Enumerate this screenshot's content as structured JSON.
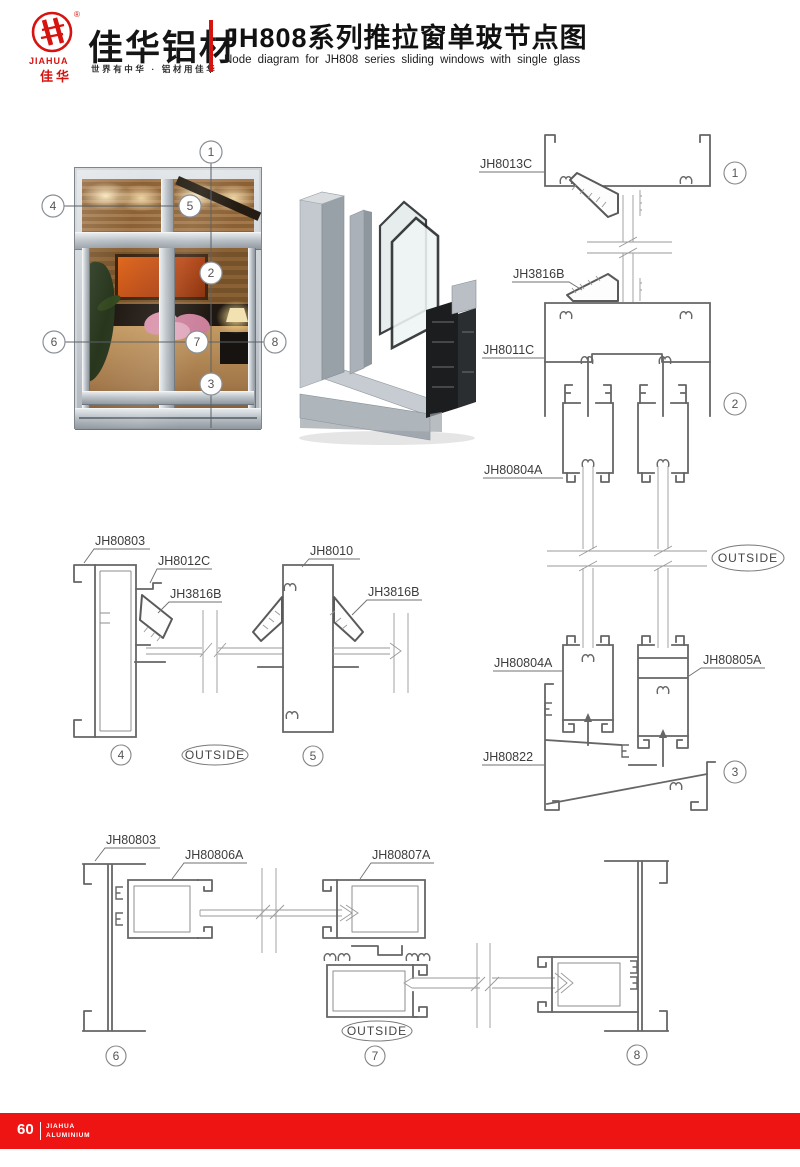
{
  "header": {
    "logo_reg": "®",
    "logo_en": "JIAHUA",
    "logo_cn": "佳华",
    "brand": "佳华铝材",
    "tagline": "世界有中华 · 铝材用佳华",
    "title_cn": "JH808系列推拉窗单玻节点图",
    "title_en": "Node diagram for JH808 series sliding windows with single glass"
  },
  "photo": {
    "callouts": [
      "1",
      "2",
      "3",
      "4",
      "5",
      "6",
      "7",
      "8"
    ]
  },
  "right_section": {
    "label_head": "JH8013C",
    "label_wedge": "JH3816B",
    "label_transom": "JH8011C",
    "label_sash_upper": "JH80804A",
    "label_sash_lower_left": "JH80804A",
    "label_sash_lower_right": "JH80805A",
    "label_sill": "JH80822",
    "outside": "OUTSIDE",
    "callout_1": "1",
    "callout_2": "2",
    "callout_3": "3"
  },
  "mid_section": {
    "label_frame": "JH80803",
    "label_sash": "JH8012C",
    "label_wedge_left": "JH3816B",
    "label_mullion": "JH8010",
    "label_wedge_right": "JH3816B",
    "outside": "OUTSIDE",
    "callout_4": "4",
    "callout_5": "5"
  },
  "bottom_section": {
    "label_frame": "JH80803",
    "label_sash_left": "JH80806A",
    "label_sash_right": "JH80807A",
    "outside": "OUTSIDE",
    "callout_6": "6",
    "callout_7": "7",
    "callout_8": "8"
  },
  "footer": {
    "page_number": "60",
    "brand_line1": "JIAHUA",
    "brand_line2": "ALUMINIUM"
  },
  "colors": {
    "accent_red": "#d6130f",
    "footer_red": "#ee1414",
    "drawing_gray": "#666666"
  }
}
